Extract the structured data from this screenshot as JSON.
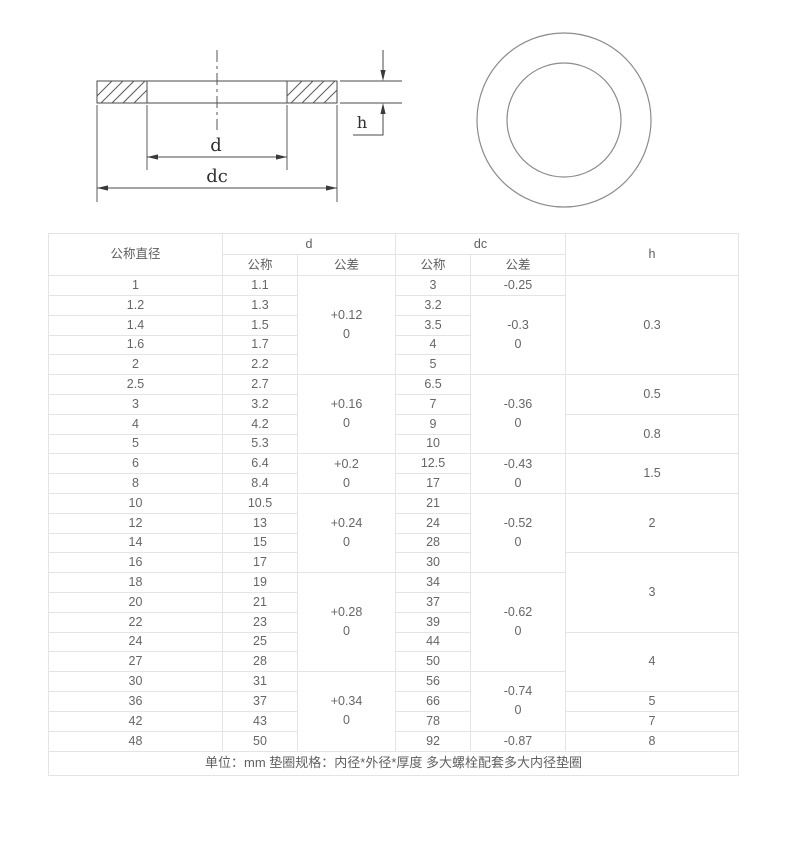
{
  "drawing": {
    "labels": {
      "d": "d",
      "dc": "dc",
      "h": "h"
    },
    "stroke_color": "#4a4a4a",
    "circle_color": "#8c8c8c"
  },
  "table": {
    "header": {
      "col_nominal": "公称直径",
      "col_d": "d",
      "col_dc": "dc",
      "col_h": "h",
      "sub_nominal": "公称",
      "sub_tolerance": "公差"
    },
    "rows": [
      {
        "nominal": "1",
        "d_nom": "1.1",
        "d_tol": [
          "+0.12",
          "0"
        ],
        "d_tol_span": 5,
        "dc_nom": "3",
        "dc_tol": [
          "-0.25"
        ],
        "dc_tol_span": 1,
        "h": "0.3",
        "h_span": 5
      },
      {
        "nominal": "1.2",
        "d_nom": "1.3",
        "dc_nom": "3.2",
        "dc_tol": [
          "-0.3",
          "0"
        ],
        "dc_tol_span": 4
      },
      {
        "nominal": "1.4",
        "d_nom": "1.5",
        "dc_nom": "3.5"
      },
      {
        "nominal": "1.6",
        "d_nom": "1.7",
        "dc_nom": "4"
      },
      {
        "nominal": "2",
        "d_nom": "2.2",
        "dc_nom": "5"
      },
      {
        "nominal": "2.5",
        "d_nom": "2.7",
        "d_tol": [
          "+0.16",
          "0"
        ],
        "d_tol_span": 4,
        "dc_nom": "6.5",
        "dc_tol": [
          "-0.36",
          "0"
        ],
        "dc_tol_span": 4,
        "h": "0.5",
        "h_span": 2
      },
      {
        "nominal": "3",
        "d_nom": "3.2",
        "dc_nom": "7"
      },
      {
        "nominal": "4",
        "d_nom": "4.2",
        "dc_nom": "9",
        "h": "0.8",
        "h_span": 2
      },
      {
        "nominal": "5",
        "d_nom": "5.3",
        "dc_nom": "10"
      },
      {
        "nominal": "6",
        "d_nom": "6.4",
        "d_tol": [
          "+0.2",
          "0"
        ],
        "d_tol_span": 2,
        "dc_nom": "12.5",
        "dc_tol": [
          "-0.43",
          "0"
        ],
        "dc_tol_span": 2,
        "h": "1.5",
        "h_span": 2
      },
      {
        "nominal": "8",
        "d_nom": "8.4",
        "dc_nom": "17"
      },
      {
        "nominal": "10",
        "d_nom": "10.5",
        "d_tol": [
          "+0.24",
          "0"
        ],
        "d_tol_span": 4,
        "dc_nom": "21",
        "dc_tol": [
          "-0.52",
          "0"
        ],
        "dc_tol_span": 4,
        "h": "2",
        "h_span": 3
      },
      {
        "nominal": "12",
        "d_nom": "13",
        "dc_nom": "24"
      },
      {
        "nominal": "14",
        "d_nom": "15",
        "dc_nom": "28"
      },
      {
        "nominal": "16",
        "d_nom": "17",
        "dc_nom": "30",
        "h": "3",
        "h_span": 4
      },
      {
        "nominal": "18",
        "d_nom": "19",
        "d_tol": [
          "+0.28",
          "0"
        ],
        "d_tol_span": 5,
        "dc_nom": "34",
        "dc_tol": [
          "-0.62",
          "0"
        ],
        "dc_tol_span": 5
      },
      {
        "nominal": "20",
        "d_nom": "21",
        "dc_nom": "37"
      },
      {
        "nominal": "22",
        "d_nom": "23",
        "dc_nom": "39"
      },
      {
        "nominal": "24",
        "d_nom": "25",
        "dc_nom": "44",
        "h": "4",
        "h_span": 3
      },
      {
        "nominal": "27",
        "d_nom": "28",
        "dc_nom": "50"
      },
      {
        "nominal": "30",
        "d_nom": "31",
        "d_tol": [
          "+0.34",
          "0"
        ],
        "d_tol_span": 4,
        "dc_nom": "56",
        "dc_tol": [
          "-0.74",
          "0"
        ],
        "dc_tol_span": 3
      },
      {
        "nominal": "36",
        "d_nom": "37",
        "dc_nom": "66",
        "h": "5",
        "h_span": 1
      },
      {
        "nominal": "42",
        "d_nom": "43",
        "dc_nom": "78",
        "h": "7",
        "h_span": 1
      },
      {
        "nominal": "48",
        "d_nom": "50",
        "dc_nom": "92",
        "dc_tol": [
          "-0.87"
        ],
        "dc_tol_span": 1,
        "h": "8",
        "h_span": 1
      }
    ],
    "footer": "单位：mm 垫圈规格：内径*外径*厚度 多大螺栓配套多大内径垫圈"
  }
}
